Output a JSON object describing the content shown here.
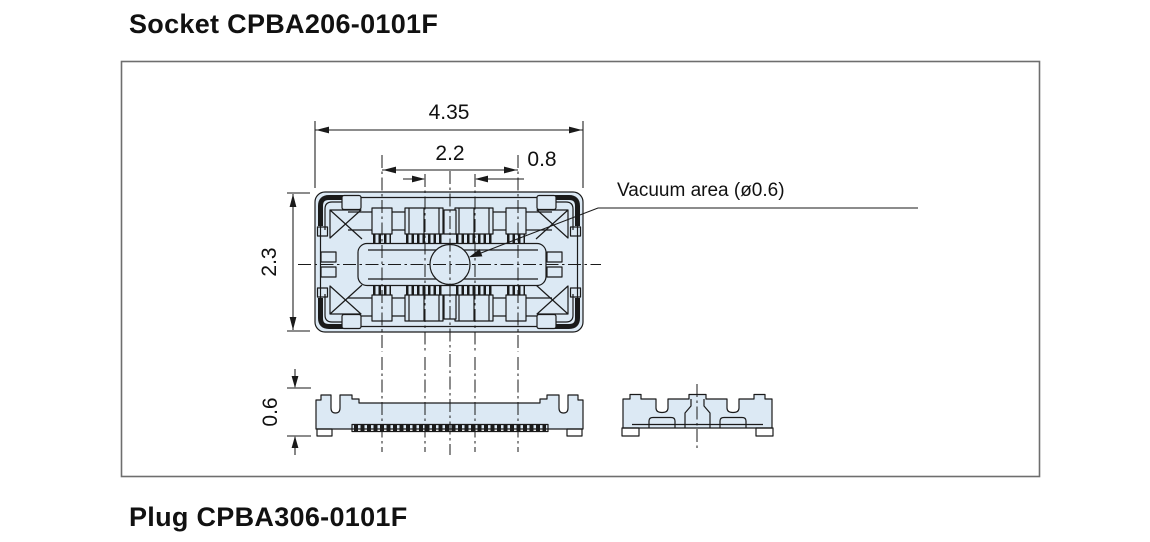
{
  "titles": {
    "socket": "Socket CPBA206-0101F",
    "plug": "Plug CPBA306-0101F"
  },
  "drawing": {
    "vacuum_label": "Vacuum area (ø0.6)",
    "dimensions": {
      "overall_width": "4.35",
      "contact_span": "2.2",
      "end_offset": "0.8",
      "body_depth": "2.3",
      "mounted_height": "0.6"
    }
  },
  "colors": {
    "page-bg": "#ffffff",
    "body-fill": "#dce9f4",
    "outline": "#1a1a1a",
    "frame-border": "#6e6e6e",
    "text-color": "#111111"
  }
}
